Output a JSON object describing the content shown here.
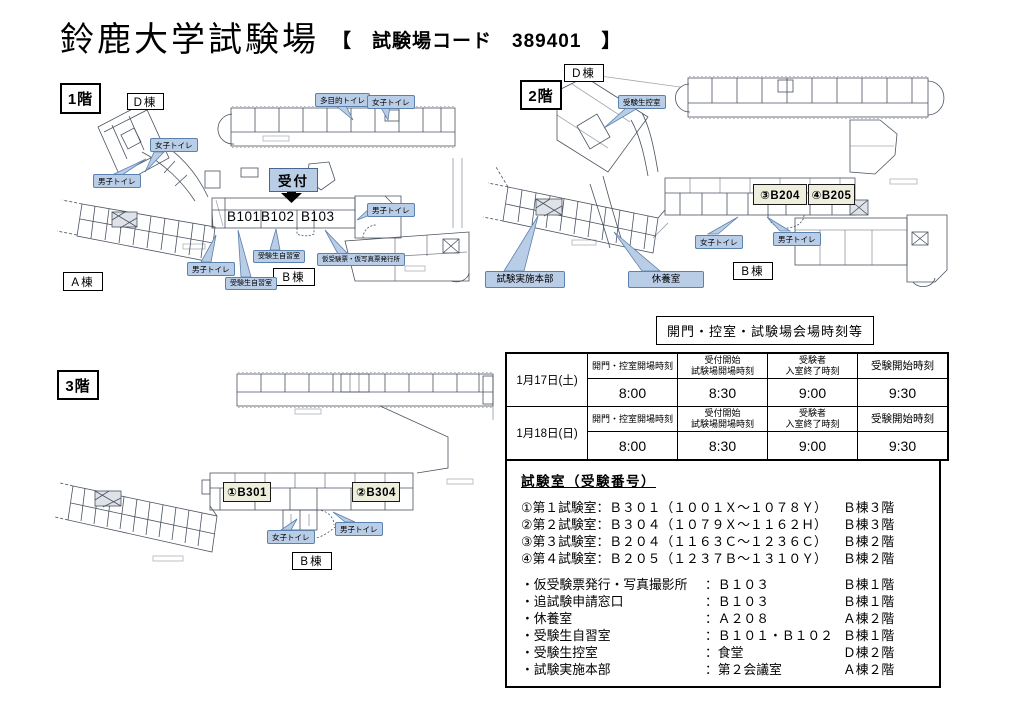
{
  "title": {
    "main": "鈴鹿大学試験場",
    "code": "【　試験場コード　389401　】"
  },
  "floor1": {
    "label": "1階",
    "building_d": "D棟",
    "building_a": "A棟",
    "building_b": "B棟",
    "reception": "受付",
    "rooms": {
      "b101": "B101",
      "b102": "B102",
      "b103": "B103"
    },
    "callouts": {
      "tamokuteki": "多目的トイレ",
      "joshi_top": "女子トイレ",
      "joshi_d": "女子トイレ",
      "danshi_d": "男子トイレ",
      "danshi_right": "男子トイレ",
      "danshi_left": "男子トイレ",
      "jishu1": "受験生自習室",
      "jishu2": "受験生自習室",
      "kari": "仮受験票・仮写真票発行所"
    }
  },
  "floor2": {
    "label": "2階",
    "building_d": "D棟",
    "building_b": "B棟",
    "rooms": {
      "b204": "③B204",
      "b205": "④B205"
    },
    "callouts": {
      "hikae": "受験生控室",
      "joshi": "女子トイレ",
      "danshi": "男子トイレ",
      "honbu": "試験実施本部",
      "kyuyo": "休養室"
    }
  },
  "floor3": {
    "label": "3階",
    "building_b": "B棟",
    "rooms": {
      "b301": "①B301",
      "b304": "②B304"
    },
    "callouts": {
      "joshi": "女子トイレ",
      "danshi": "男子トイレ"
    }
  },
  "schedule": {
    "box_title": "開門・控室・試験場会場時刻等",
    "col_headers": [
      "開門・控室開場時刻",
      "受付開始\n試験場開場時刻",
      "受験者\n入室終了時刻",
      "受験開始時刻"
    ],
    "days": [
      {
        "date": "1月17日(土)",
        "times": [
          "8:00",
          "8:30",
          "9:00",
          "9:30"
        ]
      },
      {
        "date": "1月18日(日)",
        "times": [
          "8:00",
          "8:30",
          "9:00",
          "9:30"
        ]
      }
    ]
  },
  "room_info": {
    "title": "試験室（受験番号）",
    "exam_rooms": [
      {
        "label": "①第１試験室：Ｂ３０１（１００１Ｘ～１０７８Ｙ）",
        "loc": "Ｂ棟３階"
      },
      {
        "label": "②第２試験室：Ｂ３０４（１０７９Ｘ～１１６２Ｈ）",
        "loc": "Ｂ棟３階"
      },
      {
        "label": "③第３試験室：Ｂ２０４（１１６３Ｃ～１２３６Ｃ）",
        "loc": "Ｂ棟２階"
      },
      {
        "label": "④第４試験室：Ｂ２０５（１２３７Ｂ～１３１０Ｙ）",
        "loc": "Ｂ棟２階"
      }
    ],
    "facilities": [
      {
        "name": "・仮受験票発行・写真撮影所",
        "value": "：Ｂ１０３",
        "loc": "Ｂ棟１階"
      },
      {
        "name": "・追試験申請窓口",
        "value": "：Ｂ１０３",
        "loc": "Ｂ棟１階"
      },
      {
        "name": "・休養室",
        "value": "：Ａ２０８",
        "loc": "Ａ棟２階"
      },
      {
        "name": "・受験生自習室",
        "value": "：Ｂ１０１・Ｂ１０２",
        "loc": "Ｂ棟１階"
      },
      {
        "name": "・受験生控室",
        "value": "：食堂",
        "loc": "Ｄ棟２階"
      },
      {
        "name": "・試験実施本部",
        "value": "：第２会議室",
        "loc": "Ａ棟２階"
      }
    ]
  }
}
